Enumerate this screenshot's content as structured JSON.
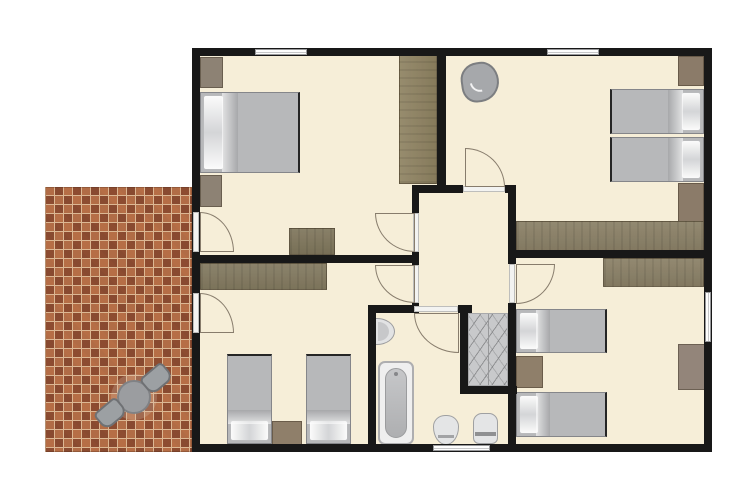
{
  "meta": {
    "kind": "apartment-floor-plan",
    "canvas": {
      "width": 755,
      "height": 504,
      "background": "#ffffff"
    }
  },
  "palette": {
    "floor": "#f6eed8",
    "wall": "#181818",
    "patioBase": "#b26c49",
    "grout": "#dcb793",
    "bedDuvet": "#b7b8ba",
    "stairs": "#c8c9cb",
    "woodDesk": "#8a8066",
    "woodCounter": "#837a60",
    "woodWardrobe": "#8e8261",
    "dresserGray": "#8d8274",
    "fixtureWhite": "#e4e5e6"
  },
  "rooms": [
    {
      "name": "bedroom-top-left",
      "furniture": [
        "double-bed",
        "wardrobe",
        "dresser",
        "desk",
        "tall-wardrobe"
      ]
    },
    {
      "name": "bedroom-top-right",
      "furniture": [
        "armchair",
        "twin-bed",
        "twin-bed",
        "wardrobe",
        "wardrobe",
        "long-desk"
      ]
    },
    {
      "name": "hallway-center",
      "furniture": []
    },
    {
      "name": "bedroom-bottom-left",
      "furniture": [
        "counter-desk",
        "twin-bed",
        "twin-bed",
        "nightstand"
      ]
    },
    {
      "name": "bathroom",
      "furniture": [
        "sink",
        "bathtub",
        "toilet",
        "bidet"
      ]
    },
    {
      "name": "stairwell",
      "furniture": [
        "stairs"
      ]
    },
    {
      "name": "bedroom-bottom-right",
      "furniture": [
        "desk",
        "twin-bed",
        "twin-bed",
        "nightstand",
        "wardrobe"
      ]
    },
    {
      "name": "patio",
      "furniture": [
        "round-table",
        "chair",
        "chair"
      ]
    }
  ],
  "floorplan": {
    "elements": [
      {
        "name": "patio-floor",
        "type": "patio",
        "x": 45,
        "y": 187,
        "w": 147,
        "h": 265
      },
      {
        "name": "building-floor",
        "type": "floor",
        "x": 192,
        "y": 48,
        "w": 520,
        "h": 404
      },
      {
        "name": "stairs",
        "type": "stairs",
        "x": 468,
        "y": 313,
        "w": 40,
        "h": 73
      },
      {
        "name": "wardrobe-topleft-corner",
        "type": "wardrobe",
        "x": 200,
        "y": 57,
        "w": 23,
        "h": 31,
        "color": "#8d8274"
      },
      {
        "name": "double-bed",
        "type": "bed",
        "x": 200,
        "y": 92,
        "w": 100,
        "h": 81,
        "mods": [
          "pillow-left",
          "foot-right"
        ]
      },
      {
        "name": "dresser-topleft",
        "type": "wardrobe",
        "x": 200,
        "y": 175,
        "w": 22,
        "h": 32,
        "color": "#8d8274"
      },
      {
        "name": "desk-topleft-room",
        "type": "desk",
        "x": 289,
        "y": 228,
        "w": 46,
        "h": 27,
        "color": "#7f765c",
        "mods": [
          "wood-h"
        ]
      },
      {
        "name": "tall-wardrobe",
        "type": "wardrobe",
        "x": 399,
        "y": 52,
        "w": 38,
        "h": 132,
        "color": "#8e8261",
        "mods": [
          "wood-v"
        ]
      },
      {
        "name": "armchair",
        "type": "armchair",
        "x": 461,
        "y": 62,
        "w": 38,
        "h": 40,
        "rot": -8
      },
      {
        "name": "wardrobe-topright-upper",
        "type": "wardrobe",
        "x": 678,
        "y": 56,
        "w": 26,
        "h": 30,
        "color": "#8b7b69"
      },
      {
        "name": "twin-bed-topright-1",
        "type": "bed",
        "x": 610,
        "y": 89,
        "w": 94,
        "h": 45,
        "mods": [
          "pillow-right",
          "foot-left"
        ]
      },
      {
        "name": "twin-bed-topright-2",
        "type": "bed",
        "x": 610,
        "y": 137,
        "w": 94,
        "h": 45,
        "mods": [
          "pillow-right",
          "foot-left"
        ]
      },
      {
        "name": "wardrobe-topright-lower",
        "type": "wardrobe",
        "x": 678,
        "y": 183,
        "w": 26,
        "h": 46,
        "color": "#8b7b69"
      },
      {
        "name": "long-desk-topright",
        "type": "desk",
        "x": 516,
        "y": 221,
        "w": 188,
        "h": 32,
        "color": "#8a8066",
        "mods": [
          "wood-h"
        ]
      },
      {
        "name": "counter-desk-bottomleft",
        "type": "desk",
        "x": 200,
        "y": 263,
        "w": 127,
        "h": 27,
        "color": "#837a60",
        "mods": [
          "wood-h"
        ]
      },
      {
        "name": "twin-bed-bottomleft-1",
        "type": "bed",
        "x": 227,
        "y": 354,
        "w": 45,
        "h": 90,
        "mods": [
          "pillow-bottom",
          "foot-top"
        ]
      },
      {
        "name": "nightstand-bottomleft",
        "type": "nightstand",
        "x": 272,
        "y": 421,
        "w": 30,
        "h": 25,
        "color": "#8f7f6a"
      },
      {
        "name": "twin-bed-bottomleft-2",
        "type": "bed",
        "x": 306,
        "y": 354,
        "w": 45,
        "h": 90,
        "mods": [
          "pillow-bottom",
          "foot-top"
        ]
      },
      {
        "name": "sink",
        "type": "sink",
        "x": 376,
        "y": 318,
        "w": 19,
        "h": 27
      },
      {
        "name": "bathtub",
        "type": "bathtub",
        "x": 378,
        "y": 361,
        "w": 36,
        "h": 84
      },
      {
        "name": "toilet",
        "type": "toilet",
        "x": 433,
        "y": 415,
        "w": 26,
        "h": 30
      },
      {
        "name": "bidet",
        "type": "bidet",
        "x": 473,
        "y": 413,
        "w": 25,
        "h": 31
      },
      {
        "name": "desk-bottomright",
        "type": "desk",
        "x": 603,
        "y": 258,
        "w": 101,
        "h": 29,
        "color": "#8a8066",
        "mods": [
          "wood-h"
        ]
      },
      {
        "name": "twin-bed-bottomright-1",
        "type": "bed",
        "x": 516,
        "y": 309,
        "w": 91,
        "h": 44,
        "mods": [
          "pillow-left",
          "foot-right"
        ]
      },
      {
        "name": "nightstand-bottomright",
        "type": "nightstand",
        "x": 516,
        "y": 356,
        "w": 27,
        "h": 32,
        "color": "#8f7f6a"
      },
      {
        "name": "twin-bed-bottomright-2",
        "type": "bed",
        "x": 516,
        "y": 392,
        "w": 91,
        "h": 45,
        "mods": [
          "pillow-left",
          "foot-right"
        ]
      },
      {
        "name": "wardrobe-bottomright",
        "type": "wardrobe",
        "x": 678,
        "y": 344,
        "w": 27,
        "h": 46,
        "color": "#93857a"
      },
      {
        "name": "wall-top",
        "type": "wall",
        "x": 192,
        "y": 48,
        "w": 520,
        "h": 8
      },
      {
        "name": "wall-bottom",
        "type": "wall",
        "x": 192,
        "y": 444,
        "w": 520,
        "h": 8
      },
      {
        "name": "wall-left",
        "type": "wall",
        "x": 192,
        "y": 48,
        "w": 8,
        "h": 404
      },
      {
        "name": "wall-right",
        "type": "wall",
        "x": 704,
        "y": 48,
        "w": 8,
        "h": 404
      },
      {
        "name": "wall-divider-top-rooms",
        "type": "wall",
        "x": 437,
        "y": 48,
        "w": 9,
        "h": 144
      },
      {
        "name": "wall-hallway-top-left",
        "type": "wall",
        "x": 412,
        "y": 185,
        "w": 51,
        "h": 8
      },
      {
        "name": "wall-hallway-top-right",
        "type": "wall",
        "x": 505,
        "y": 185,
        "w": 11,
        "h": 8
      },
      {
        "name": "wall-topright-room-bottom",
        "type": "wall",
        "x": 508,
        "y": 250,
        "w": 204,
        "h": 8
      },
      {
        "name": "wall-hallway-left-a",
        "type": "wall",
        "x": 412,
        "y": 185,
        "w": 7,
        "h": 28
      },
      {
        "name": "wall-hallway-left-b",
        "type": "wall",
        "x": 412,
        "y": 252,
        "w": 7,
        "h": 13
      },
      {
        "name": "wall-hallway-left-c",
        "type": "wall",
        "x": 412,
        "y": 303,
        "w": 7,
        "h": 10
      },
      {
        "name": "wall-hallway-right-a",
        "type": "wall",
        "x": 508,
        "y": 185,
        "w": 8,
        "h": 79
      },
      {
        "name": "wall-hallway-right-b",
        "type": "wall",
        "x": 508,
        "y": 303,
        "w": 8,
        "h": 141
      },
      {
        "name": "wall-divider-left-rooms",
        "type": "wall",
        "x": 192,
        "y": 255,
        "w": 227,
        "h": 8
      },
      {
        "name": "wall-bathroom-left",
        "type": "wall",
        "x": 368,
        "y": 305,
        "w": 8,
        "h": 139
      },
      {
        "name": "wall-bathroom-top",
        "type": "wall",
        "x": 368,
        "y": 305,
        "w": 46,
        "h": 8
      },
      {
        "name": "wall-hall-bottom-stub",
        "type": "wall",
        "x": 458,
        "y": 305,
        "w": 14,
        "h": 8
      },
      {
        "name": "wall-stairs-left",
        "type": "wall",
        "x": 460,
        "y": 313,
        "w": 8,
        "h": 80
      },
      {
        "name": "wall-stairs-bottom",
        "type": "wall",
        "x": 460,
        "y": 386,
        "w": 57,
        "h": 8
      },
      {
        "name": "window-top-left-room",
        "type": "window",
        "x": 255,
        "y": 49,
        "w": 52,
        "h": 6,
        "mods": [
          "h"
        ]
      },
      {
        "name": "window-top-right-room",
        "type": "window",
        "x": 547,
        "y": 49,
        "w": 52,
        "h": 6,
        "mods": [
          "h"
        ]
      },
      {
        "name": "window-right-wall",
        "type": "window",
        "x": 705,
        "y": 292,
        "w": 6,
        "h": 50,
        "mods": [
          "v"
        ]
      },
      {
        "name": "window-bathroom",
        "type": "window",
        "x": 433,
        "y": 445,
        "w": 57,
        "h": 6,
        "mods": [
          "h"
        ]
      },
      {
        "name": "threshold-patio-top-door",
        "type": "threshold",
        "x": 193,
        "y": 212,
        "w": 6,
        "h": 40
      },
      {
        "name": "threshold-patio-bottom-door",
        "type": "threshold",
        "x": 193,
        "y": 293,
        "w": 6,
        "h": 40
      },
      {
        "name": "threshold-hallway-top",
        "type": "threshold",
        "x": 463,
        "y": 186,
        "w": 42,
        "h": 6
      },
      {
        "name": "threshold-hallway-left-1",
        "type": "threshold",
        "x": 413,
        "y": 213,
        "w": 6,
        "h": 39
      },
      {
        "name": "threshold-hallway-left-2",
        "type": "threshold",
        "x": 413,
        "y": 265,
        "w": 6,
        "h": 38
      },
      {
        "name": "threshold-hallway-right",
        "type": "threshold",
        "x": 509,
        "y": 264,
        "w": 6,
        "h": 39
      },
      {
        "name": "threshold-bathroom",
        "type": "threshold",
        "x": 414,
        "y": 306,
        "w": 44,
        "h": 6
      },
      {
        "name": "door-patio-to-topleft",
        "type": "door",
        "x": 200,
        "y": 212,
        "w": 34,
        "h": 40,
        "mods": [
          "corner-tr"
        ]
      },
      {
        "name": "door-patio-to-bottomleft",
        "type": "door",
        "x": 200,
        "y": 293,
        "w": 34,
        "h": 40,
        "mods": [
          "corner-tr"
        ]
      },
      {
        "name": "door-hall-to-topleft",
        "type": "door",
        "x": 375,
        "y": 213,
        "w": 40,
        "h": 39,
        "mods": [
          "corner-bl"
        ]
      },
      {
        "name": "door-hall-to-bottomleft",
        "type": "door",
        "x": 375,
        "y": 265,
        "w": 40,
        "h": 38,
        "mods": [
          "corner-bl"
        ]
      },
      {
        "name": "door-hall-to-topright",
        "type": "door",
        "x": 465,
        "y": 148,
        "w": 40,
        "h": 39,
        "mods": [
          "corner-tr"
        ]
      },
      {
        "name": "door-hall-to-bottomright",
        "type": "door",
        "x": 516,
        "y": 264,
        "w": 39,
        "h": 40,
        "mods": [
          "corner-br"
        ]
      },
      {
        "name": "door-hall-to-bathroom",
        "type": "door",
        "x": 414,
        "y": 313,
        "w": 45,
        "h": 40,
        "mods": [
          "corner-bl"
        ]
      },
      {
        "name": "patio-round-table",
        "type": "table",
        "x": 117,
        "y": 380,
        "w": 34,
        "h": 34
      },
      {
        "name": "patio-chair-upper",
        "type": "chair",
        "x": 142,
        "y": 368,
        "w": 29,
        "h": 21,
        "rot": -40
      },
      {
        "name": "patio-chair-lower",
        "type": "chair",
        "x": 96,
        "y": 403,
        "w": 29,
        "h": 21,
        "rot": -40
      }
    ]
  }
}
